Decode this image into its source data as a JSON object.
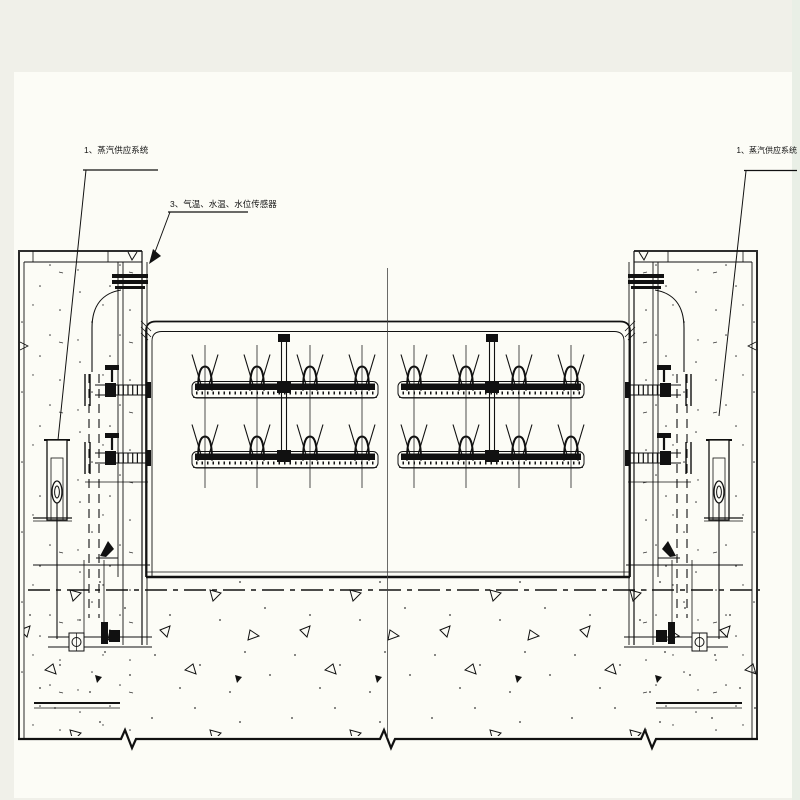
{
  "drawing": {
    "type": "engineering-cross-section",
    "callouts": {
      "left_system": "1、蒸汽供应系统",
      "sensors": "3、气温、水温、水位传感器",
      "right_system": "1、蒸汽供应系统"
    }
  },
  "colors": {
    "ink": "#141414",
    "paper": "#fcfcf6",
    "margin": "#f0f0e9",
    "edge_tint": "#e9efe6"
  }
}
